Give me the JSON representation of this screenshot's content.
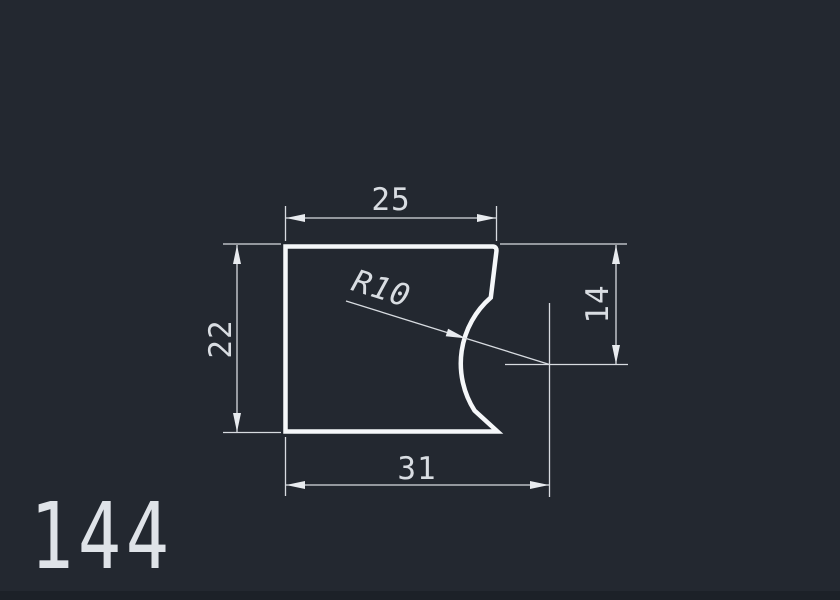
{
  "drawing": {
    "part_number": "144",
    "dimensions": {
      "top_width": "25",
      "left_height": "22",
      "right_height": "14",
      "bottom_width": "31",
      "radius": "R10"
    },
    "colors": {
      "background": "#232830",
      "outline": "#f5f7f9",
      "dimension_lines": "#d7dbe0",
      "text": "#d9dde2",
      "bottom_strip": "#1c2128"
    }
  }
}
